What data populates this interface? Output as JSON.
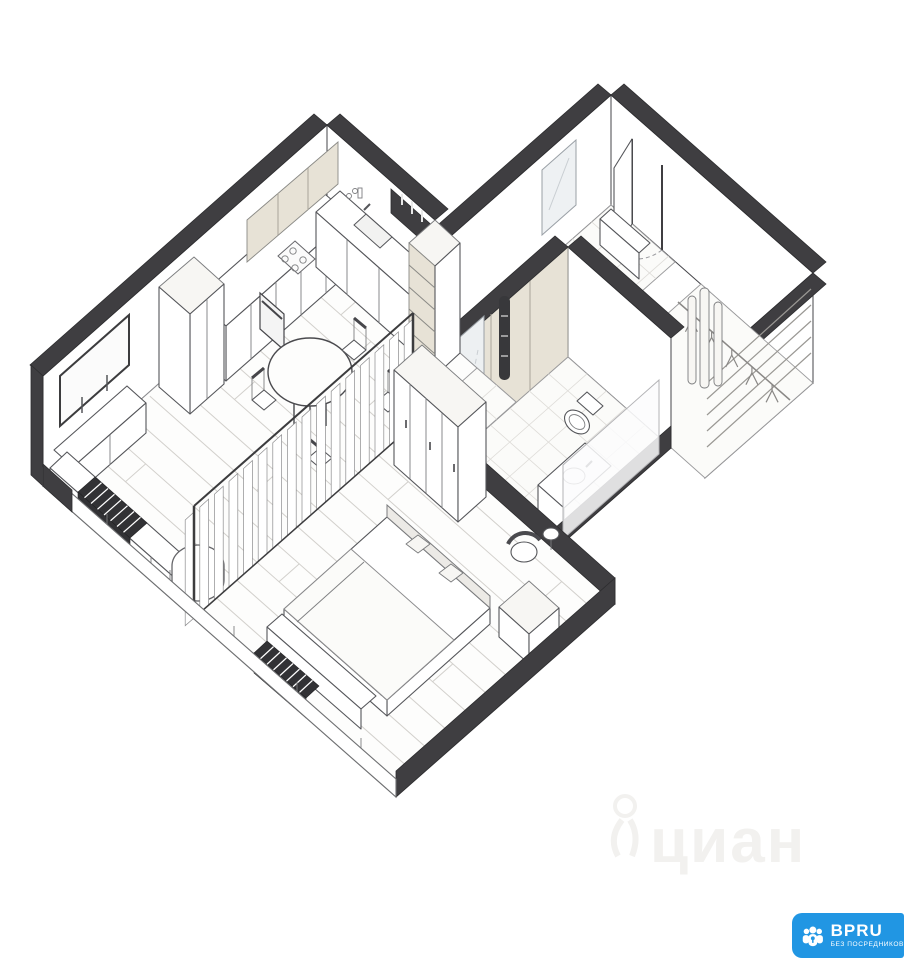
{
  "page": {
    "background": "#ffffff",
    "width": 904,
    "height": 960
  },
  "watermark": {
    "text": "циан"
  },
  "logo": {
    "title": "BPRU",
    "subtitle": "БЕЗ ПОСРЕДНИКОВ"
  },
  "colors": {
    "wall": "#3f3e41",
    "accent": "#e7e2d6",
    "logo": "#2196e3",
    "watermark": "#f2f1ef",
    "floor_line": "#d2d0cc",
    "tile_line": "#dedcd8"
  },
  "icons": {
    "logo_icon": "people-group-with-keyhole-icon",
    "watermark_icon": "person-figure-icon"
  },
  "diagram": {
    "type": "floor-plan-3d",
    "projection": "military-axonometric-dollhouse",
    "rooms": [
      {
        "name": "kitchen-living-room"
      },
      {
        "name": "bedroom"
      },
      {
        "name": "bathroom"
      },
      {
        "name": "entry-hall"
      },
      {
        "name": "walk-in-closet"
      },
      {
        "name": "hallway"
      }
    ],
    "furniture": [
      "kitchen-base-cabinets",
      "kitchen-upper-cabinets",
      "kitchen-counter-sink",
      "cooktop",
      "oven",
      "tall-shelf-column",
      "tall-cabinet",
      "dining-table",
      "dining-chairs",
      "tv",
      "tv-console",
      "window-bench",
      "radiator-living",
      "radiator-bedroom",
      "pouf",
      "slat-curtain-partition",
      "double-bed",
      "pillows",
      "headboard",
      "bed-bench",
      "nightstand",
      "armchair",
      "side-table",
      "wardrobe",
      "toilet",
      "vanity-sink",
      "bathtub",
      "towel-radiator",
      "bathroom-mirror",
      "shower-glass",
      "entry-bench",
      "entry-mirror",
      "entry-door",
      "closet-shelves",
      "clothes-rail",
      "hangers",
      "storage-box"
    ]
  }
}
